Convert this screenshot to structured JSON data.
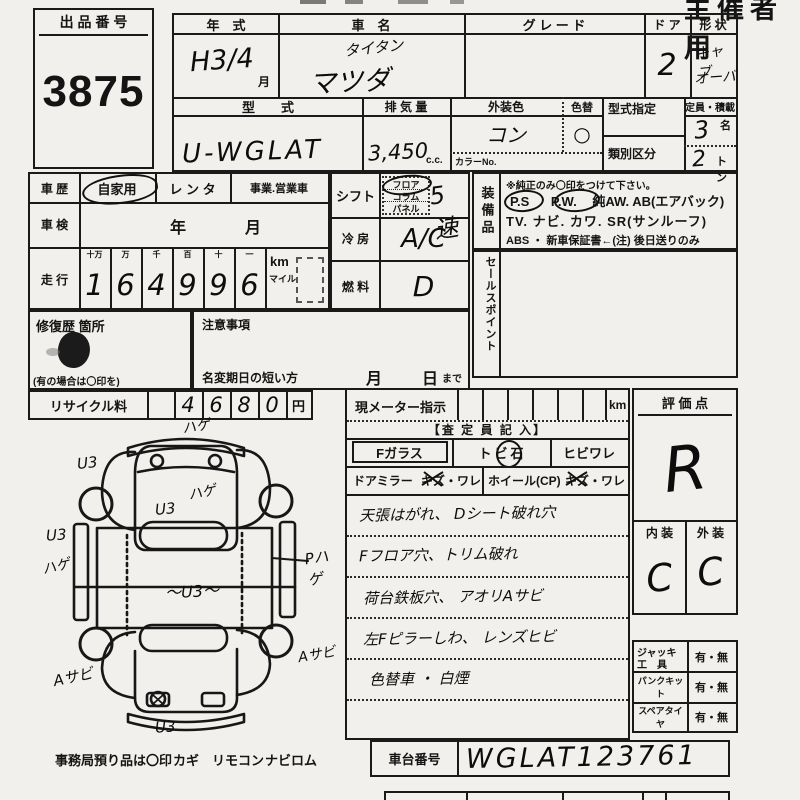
{
  "page": {
    "corner_mark": "主催者用"
  },
  "auction": {
    "label": "出 品 番 号",
    "number": "3875"
  },
  "top": {
    "year_label": "年　式",
    "name_label": "車　名",
    "grade_label": "グ レ ー ド",
    "door_label": "ド ア",
    "shape_label": "形 状",
    "year_value": "H3/4",
    "year_month": "月",
    "name_line1": "タイタン",
    "name_line2": "マツダ",
    "door_value": "2",
    "shape_line1": "キャブ",
    "shape_line2": "オーバ",
    "model_label": "型　　式",
    "model_value": "U-WGLAT",
    "disp_label": "排 気 量",
    "disp_value": "3,450",
    "disp_unit": "c.c.",
    "color_label": "外装色",
    "color_value": "コン",
    "colorchg_label": "色替",
    "colorchg_value": "○",
    "colorno_label": "カラーNo.",
    "typedes_label": "型式指定",
    "class_label": "類別区分",
    "cap_label": "定員・積載",
    "cap_value": "3",
    "cap_unit": "名",
    "load_value": "2",
    "load_unit": "トン"
  },
  "history": {
    "label": "車 歴",
    "opt1": "自家用",
    "opt2": "レ ン タ",
    "opt3": "事業.営業車",
    "insp_label": "車 検",
    "insp_year": "年",
    "insp_month": "月",
    "run_label": "走 行",
    "u0": "十万",
    "u1": "万",
    "u2": "千",
    "u3": "百",
    "u4": "十",
    "u5": "一",
    "d0": "1",
    "d1": "6",
    "d2": "4",
    "d3": "9",
    "d4": "9",
    "d5": "6",
    "km": "km",
    "mile": "マイル"
  },
  "repair": {
    "label": "修復歴 箇所",
    "note": "(有の場合は〇印を)"
  },
  "caution": {
    "label": "注意事項",
    "deadline": "名変期日の短い方",
    "month": "月",
    "day": "日",
    "made": "まで"
  },
  "recycle": {
    "label": "リサイクル料",
    "d1": "4",
    "d2": "6",
    "d3": "8",
    "d4": "0",
    "yen": "円"
  },
  "shift": {
    "label": "シフト",
    "opt1": "フロア",
    "opt2": "コラム",
    "opt3": "パネル",
    "value": "5速",
    "cool_label": "冷 房",
    "cool_value": "A/C",
    "fuel_label": "燃 料",
    "fuel_value": "D"
  },
  "equipment": {
    "label": "装備品",
    "note": "※純正のみ〇印をつけて下さい。",
    "ps": "P.S",
    "pw": "P.W.",
    "line1_rest": "純AW.  AB(エアバック)",
    "line2": "TV. ナビ. カワ. SR(サンルーフ)",
    "line3": "ABS ・ 新車保証書←(注) 後日送りのみ"
  },
  "sales": {
    "label": "セールスポイント"
  },
  "meter": {
    "label": "現メーター指示",
    "unit": "km"
  },
  "assessor": {
    "header": "【査 定 員 記 入】",
    "fglass": "Fガラス",
    "tobi_a": "ト",
    "tobi_b": "ビ",
    "tobi_c": "石",
    "hibi": "ヒビワレ",
    "mirror": "ドアミラー",
    "kizu1": "キズ・ワレ",
    "wheel": "ホイール(CP)",
    "kizu2": "キズ・ワレ",
    "note1": "天張はがれ、 Dシート破れ穴",
    "note2": "Fフロア穴、トリム破れ",
    "note3": "荷台鉄板穴、 アオリAサビ",
    "note4": "左Fピラーしわ、 レンズヒビ",
    "note5": "色替車 ・ 白煙"
  },
  "evaluation": {
    "label": "評 価 点",
    "score": "R",
    "interior_label": "内 装",
    "exterior_label": "外 装",
    "interior": "C",
    "exterior": "C"
  },
  "accessories": {
    "jack_l1": "ジャッキ",
    "jack_l2": "工　具",
    "jack_v": "有・無",
    "pank": "パンクキット",
    "pank_v": "有・無",
    "spare": "スペアタイヤ",
    "spare_v": "有・無"
  },
  "diagram": {
    "top": "ハゲ",
    "upper_left": "U3",
    "cab_hage": "ハゲ",
    "cab_u3": "U3",
    "left": "U3",
    "left_lower": "ハゲ",
    "center": "〜U3〜",
    "right": "Pハゲ",
    "bottom_left": "Aサビ",
    "bottom_right": "Aサビ",
    "bottom": "U3"
  },
  "footer": {
    "office": "事務局預り品は〇印",
    "item1": "カギ",
    "item2": "リモコン",
    "item3": "ナビロム",
    "chassis_label": "車台番号",
    "chassis_value": "WGLAT123761"
  }
}
